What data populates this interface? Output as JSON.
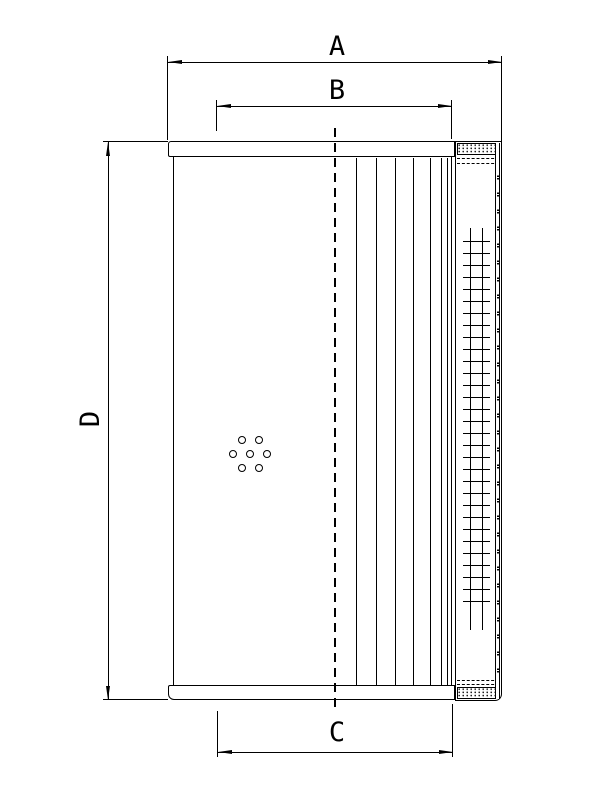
{
  "page": {
    "background_color": "#ffffff",
    "ink_color": "#000000"
  },
  "dimensions": {
    "a": {
      "label": "A"
    },
    "b": {
      "label": "B"
    },
    "c": {
      "label": "C"
    },
    "d": {
      "label": "D"
    }
  }
}
